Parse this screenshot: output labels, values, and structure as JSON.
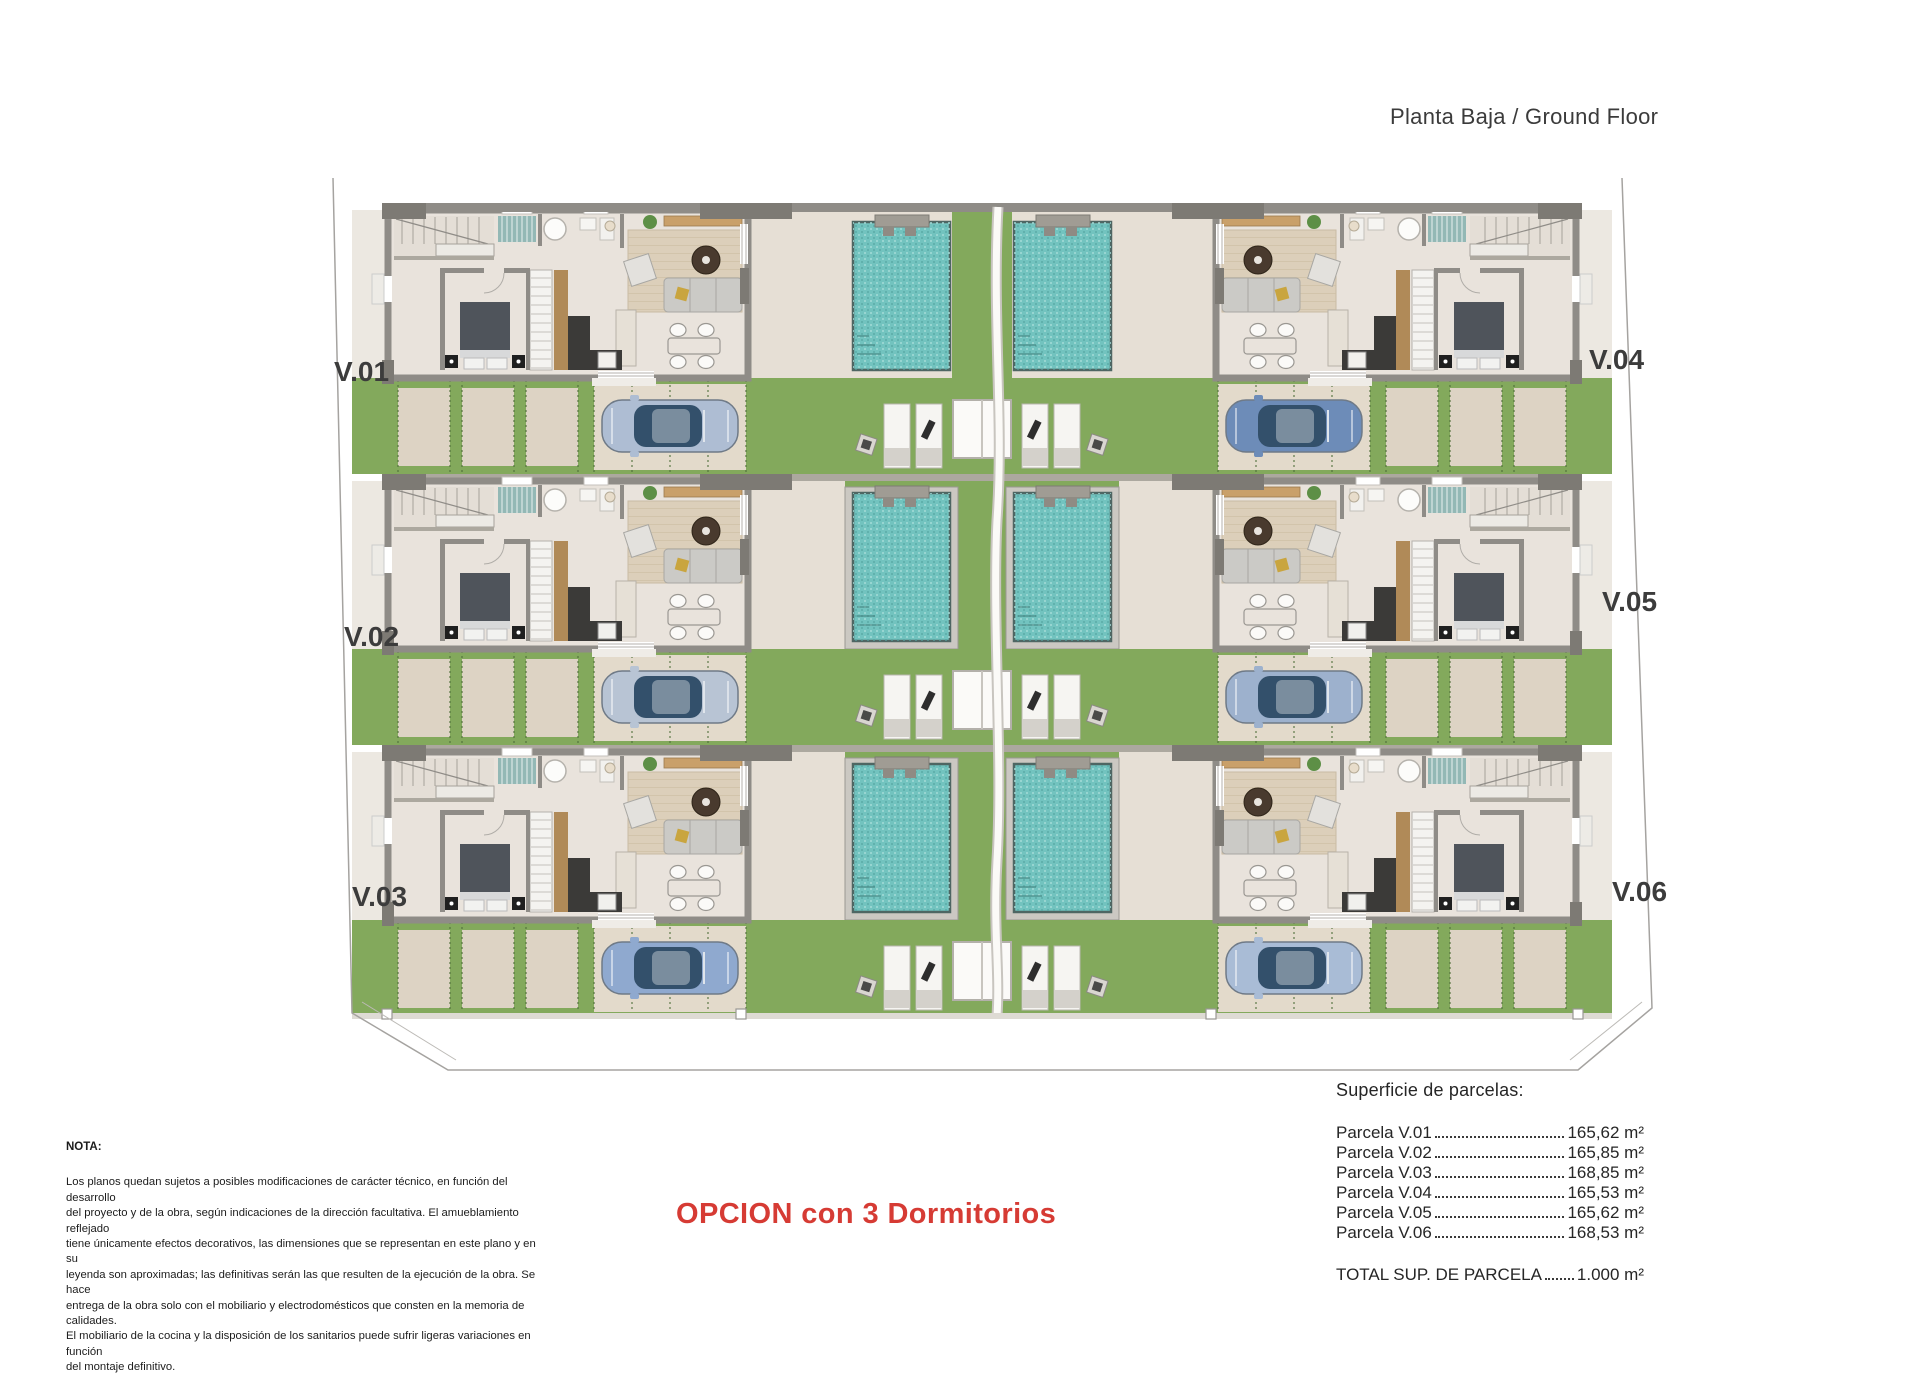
{
  "title": "Planta Baja / Ground Floor",
  "option_label": "OPCION con 3 Dormitorios",
  "note": {
    "heading": "NOTA:",
    "lines": [
      "Los planos quedan sujetos a posibles modificaciones de carácter técnico, en función del desarrollo",
      "del proyecto y de la obra, según indicaciones de la dirección facultativa. El amueblamiento reflejado",
      "tiene únicamente efectos decorativos, las dimensiones que se representan en este plano y en su",
      "leyenda son aproximadas; las definitivas serán las que resulten de la ejecución de la obra. Se hace",
      "entrega de la obra solo con el mobiliario y electrodomésticos que consten en la memoria de calidades.",
      "El mobiliario de la cocina y la disposición de los sanitarios puede sufrir ligeras variaciones en función",
      "del montaje definitivo."
    ]
  },
  "parcels": {
    "heading": "Superficie de parcelas:",
    "items": [
      {
        "label": "Parcela V.01",
        "value": "165,62 m²"
      },
      {
        "label": "Parcela V.02",
        "value": "165,85 m²"
      },
      {
        "label": "Parcela V.03",
        "value": "168,85 m²"
      },
      {
        "label": "Parcela V.04",
        "value": "165,53 m²"
      },
      {
        "label": "Parcela V.05",
        "value": "165,62 m²"
      },
      {
        "label": "Parcela V.06",
        "value": "168,53 m²"
      }
    ],
    "total": {
      "label": "TOTAL SUP. DE PARCELA",
      "value": "1.000 m²"
    }
  },
  "villas": [
    {
      "id": "V.01",
      "side": "left",
      "row": 0,
      "car_color": "#aebdd3"
    },
    {
      "id": "V.02",
      "side": "left",
      "row": 1,
      "car_color": "#b8c4d4"
    },
    {
      "id": "V.03",
      "side": "left",
      "row": 2,
      "car_color": "#8fa9cf"
    },
    {
      "id": "V.04",
      "side": "right",
      "row": 0,
      "car_color": "#6d8cb8"
    },
    {
      "id": "V.05",
      "side": "right",
      "row": 1,
      "car_color": "#9db1cd"
    },
    {
      "id": "V.06",
      "side": "right",
      "row": 2,
      "car_color": "#a9bcd6"
    }
  ],
  "colors": {
    "wall": "#8f8c87",
    "wall_dark": "#7d7a74",
    "wall_light": "#aca89f",
    "floor": "#e9e3dc",
    "terrace": "#e6dfd5",
    "side_path": "#ece8e1",
    "slab": "#ddd3c4",
    "slab_light": "#e3dacb",
    "grass": "#83a95c",
    "grass_line": "#4f6f3a",
    "pool": "#72c3bf",
    "pool_edge": "#4e6663",
    "coping": "#cbc8c2",
    "rug": "#dccfba",
    "wood": "#b08a58",
    "counter": "#3b3a38",
    "sofa": "#cbcac6",
    "coffee_table": "#493a2e",
    "bed": "#4f545b",
    "plant": "#5d8f46",
    "car_glass": "#33506b",
    "boundary": "#a5a3a0",
    "option_red": "#d63b34",
    "label_text": "#3c3c3c"
  }
}
